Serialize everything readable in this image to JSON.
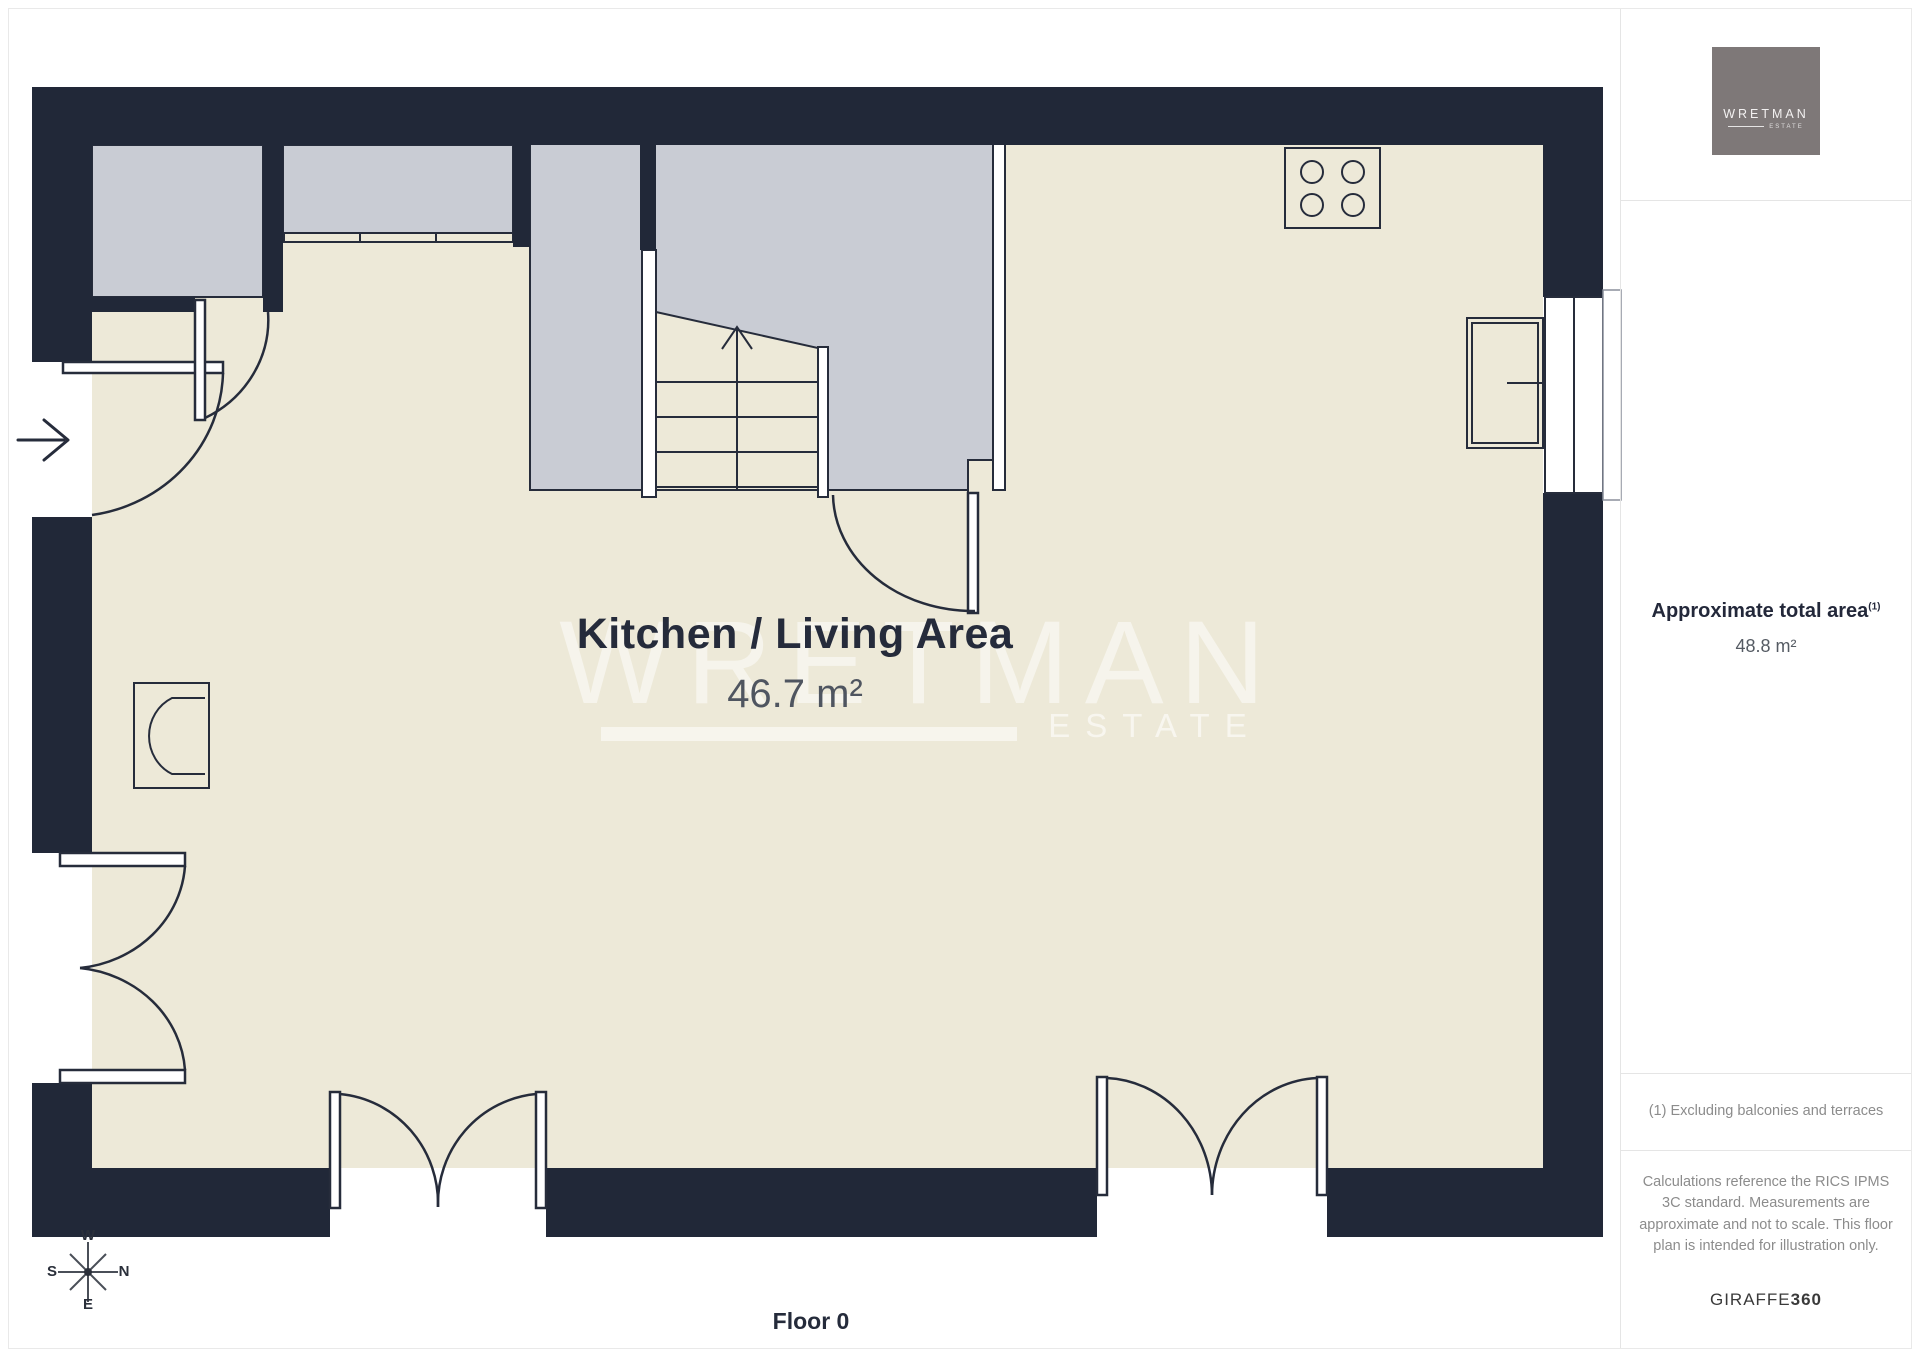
{
  "floor_plan": {
    "room_label": "Kitchen / Living Area",
    "room_area": "46.7 m²",
    "floor_label": "Floor 0",
    "watermark": {
      "line1": "WRETMAN",
      "line2": "ESTATE"
    },
    "compass": {
      "top": "W",
      "left": "S",
      "right": "N",
      "bottom": "E"
    }
  },
  "sidebar": {
    "logo": {
      "brand": "WRETMAN",
      "sub": "ESTATE"
    },
    "area_title": "Approximate total area",
    "area_title_sup": "(1)",
    "area_value": "48.8 m²",
    "footnote": "(1) Excluding balconies and terraces",
    "disclaimer": "Calculations reference the RICS IPMS 3C standard. Measurements are approximate and not to scale. This floor plan is intended for illustration only.",
    "brand_footer_name": "GIRAFFE",
    "brand_footer_suffix": "360"
  },
  "colors": {
    "wall": "#212838",
    "floor": "#ede9d8",
    "other_room": "#c9ccd4",
    "line": "#262c3b",
    "label": "#252b3b",
    "muted_text": "#8c8c8c",
    "logo_bg": "#7e7878"
  }
}
